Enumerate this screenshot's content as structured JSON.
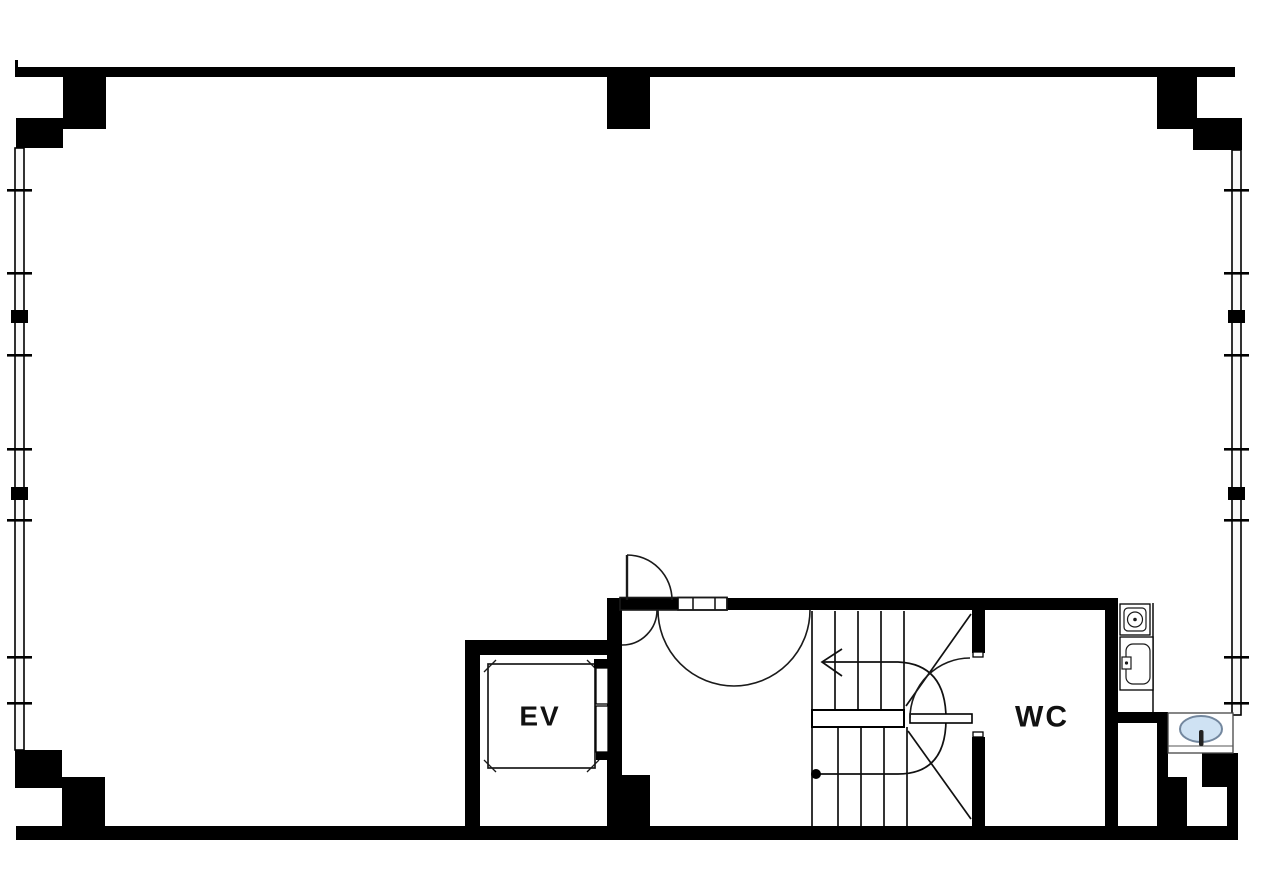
{
  "plan": {
    "labels": {
      "elevator": "EV",
      "toilet": "WC"
    },
    "colors": {
      "wall": "#000000",
      "line": "#1a1a1a",
      "basin_fill": "#cfe2f3",
      "basin_stroke": "#73879e",
      "background": "#ffffff",
      "text": "#111111"
    }
  }
}
